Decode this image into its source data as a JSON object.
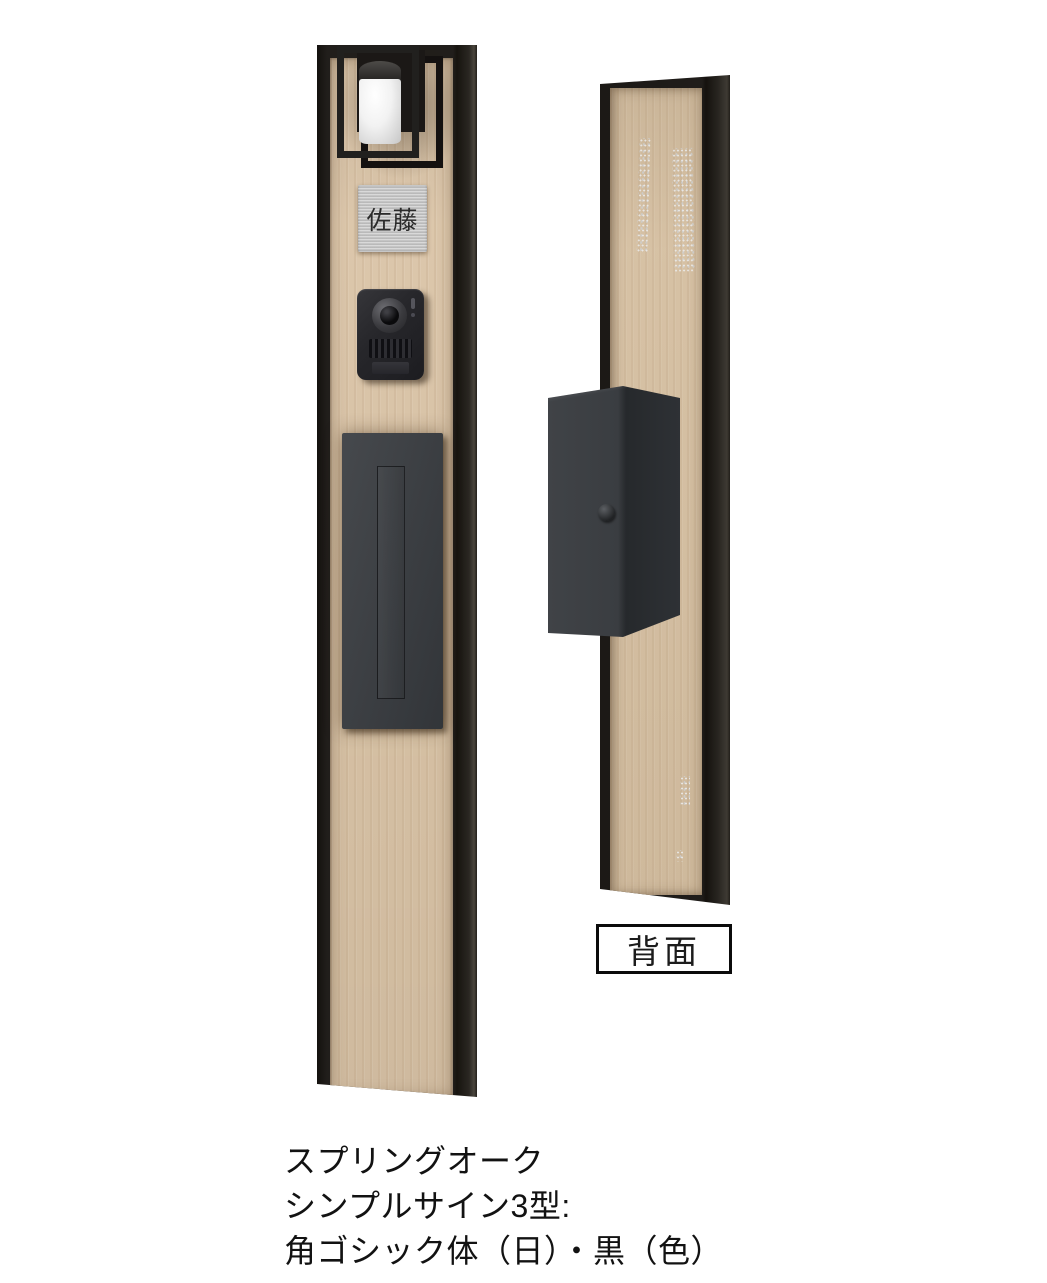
{
  "product": {
    "front": {
      "nameplate_text": "佐藤"
    },
    "back": {
      "view_label": "背面"
    },
    "caption": {
      "lines": [
        "スプリングオーク",
        "シンプルサイン3型:",
        "角ゴシック体（日）・黒（色）"
      ]
    },
    "colors": {
      "background": "#ffffff",
      "frame_black": "#211e1b",
      "wood_front": "#dac4a7",
      "wood_back": "#d5bfa1",
      "mailbox_gray": "#3b3e42",
      "nameplate_silver": "#c5c5c5",
      "lamp_diffuser_white": "#f2f2f2",
      "label_border_black": "#0b0b0b",
      "text_black": "#121212"
    }
  }
}
